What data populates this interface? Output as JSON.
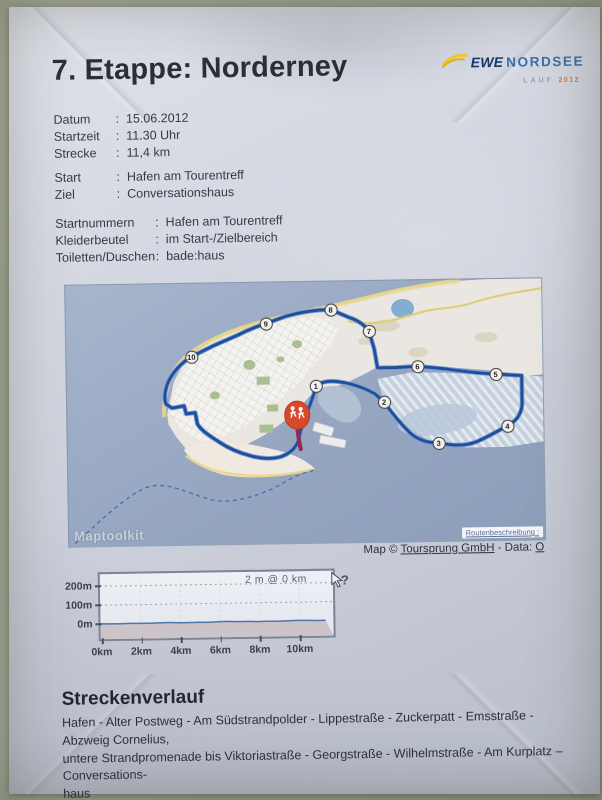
{
  "page": {
    "title": "7. Etappe: Norderney"
  },
  "logo": {
    "brand": "EWE",
    "brand2": "NORDSEE",
    "sub_label": "LAUF",
    "sub_year": "2012"
  },
  "info": {
    "groups": [
      [
        {
          "label": "Datum",
          "value": "15.06.2012"
        },
        {
          "label": "Startzeit",
          "value": "11.30 Uhr"
        },
        {
          "label": "Strecke",
          "value": "11,4 km"
        }
      ],
      [
        {
          "label": "Start",
          "value": "Hafen am Tourentreff"
        },
        {
          "label": "Ziel",
          "value": "Conversationshaus"
        }
      ],
      [
        {
          "label": "Startnummern",
          "value": "Hafen am Tourentreff"
        },
        {
          "label": "Kleiderbeutel",
          "value": "im Start-/Zielbereich"
        },
        {
          "label": "Toiletten/Duschen",
          "value": "bade:haus"
        }
      ]
    ]
  },
  "map": {
    "watermark": "Maptoolkit",
    "route_link": "Routenbeschreibung :",
    "attribution": {
      "prefix": "Map © ",
      "link": "Toursprung GmbH",
      "middle": " - Data: ",
      "data_link": "O"
    },
    "waypoints": [
      {
        "label": "1",
        "x": 249,
        "y": 104
      },
      {
        "label": "2",
        "x": 317,
        "y": 121
      },
      {
        "label": "3",
        "x": 371,
        "y": 163
      },
      {
        "label": "4",
        "x": 440,
        "y": 147
      },
      {
        "label": "5",
        "x": 429,
        "y": 95
      },
      {
        "label": "6",
        "x": 351,
        "y": 86
      },
      {
        "label": "7",
        "x": 303,
        "y": 50
      },
      {
        "label": "8",
        "x": 265,
        "y": 28
      },
      {
        "label": "9",
        "x": 200,
        "y": 41
      },
      {
        "label": "10",
        "x": 125,
        "y": 73
      }
    ],
    "marker": {
      "kind": "start-finish-runner-marker",
      "x": 230,
      "y": 133
    }
  },
  "chart_data": {
    "type": "area",
    "title": "",
    "tooltip": "2 m @ 0 km",
    "x_ticks": [
      "0km",
      "2km",
      "4km",
      "6km",
      "8km",
      "10km"
    ],
    "y_ticks": [
      "200m",
      "100m",
      "0m"
    ],
    "xlabel": "",
    "ylabel": "",
    "x_range_km": [
      0,
      11.9
    ],
    "y_range_m": [
      -75,
      290
    ],
    "grid": "dashed horizontal at 100m and 200m, faint vertical at 2km steps",
    "series": [
      {
        "name": "elevation_m",
        "x_step_km": 0.5,
        "values": [
          2,
          1,
          1,
          2,
          1,
          1,
          2,
          3,
          1,
          1,
          2,
          1,
          3,
          4,
          2,
          3,
          1,
          2,
          1,
          2,
          4,
          3,
          2,
          2
        ]
      }
    ]
  },
  "route_section": {
    "heading": "Streckenverlauf",
    "lines": [
      "Hafen - Alter Postweg - Am Südstrandpolder - Lippestraße - Zuckerpatt - Emsstraße - Abzweig Cornelius,",
      "untere Strandpromenade bis Viktoriastraße - Georgstraße - Wilhelmstraße - Am Kurplatz – Conversations-",
      "haus"
    ]
  }
}
